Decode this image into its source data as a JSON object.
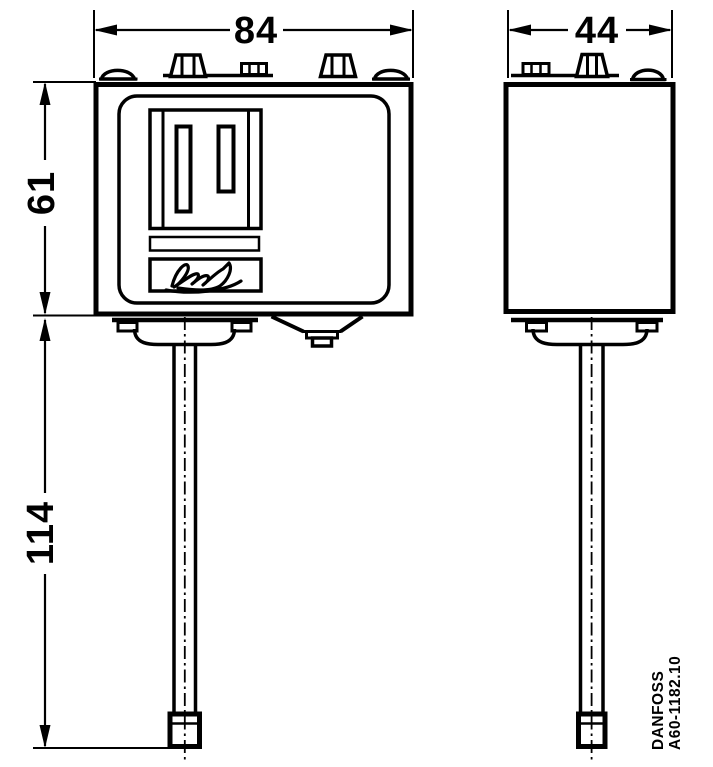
{
  "drawing": {
    "type": "technical-dimension-drawing",
    "colors": {
      "line": "#000000",
      "background": "#ffffff"
    },
    "dimensions": {
      "front_width": "84",
      "side_width": "44",
      "body_height": "61",
      "stem_length": "114"
    },
    "label": {
      "brand": "DANFOSS",
      "code": "A60-1182.10"
    },
    "icons": {
      "logo": "danfoss-signature"
    }
  }
}
